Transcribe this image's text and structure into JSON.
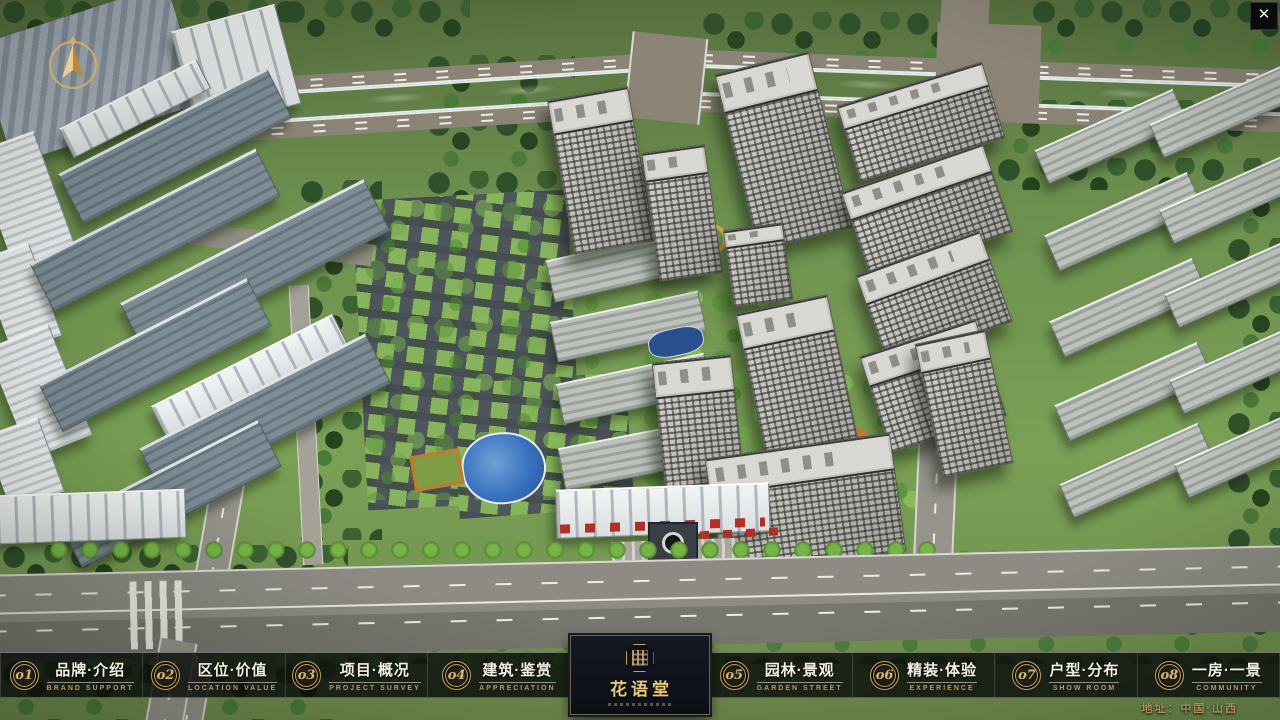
{
  "app": {
    "close_label": "✕"
  },
  "nav": {
    "items": [
      {
        "num": "o1",
        "title": "品牌·介绍",
        "subtitle": "BRAND SUPPORT"
      },
      {
        "num": "o2",
        "title": "区位·价值",
        "subtitle": "LOCATION VALUE"
      },
      {
        "num": "o3",
        "title": "项目·概况",
        "subtitle": "PROJECT SURVEY"
      },
      {
        "num": "o4",
        "title": "建筑·鉴赏",
        "subtitle": "APPRECIATION"
      },
      {
        "num": "o5",
        "title": "园林·景观",
        "subtitle": "GARDEN STREET"
      },
      {
        "num": "o6",
        "title": "精装·体验",
        "subtitle": "EXPERIENCE"
      },
      {
        "num": "o7",
        "title": "户型·分布",
        "subtitle": "SHOW ROOM"
      },
      {
        "num": "o8",
        "title": "一房·一景",
        "subtitle": "COMMUNITY"
      }
    ]
  },
  "logo": {
    "title": "花语堂"
  },
  "footer": {
    "address": "地址：中国·山西"
  },
  "colors": {
    "accent_gold": "#c8a25e",
    "bar_bg": "rgba(10,12,11,0.82)",
    "river_blue": "#3a72be"
  }
}
